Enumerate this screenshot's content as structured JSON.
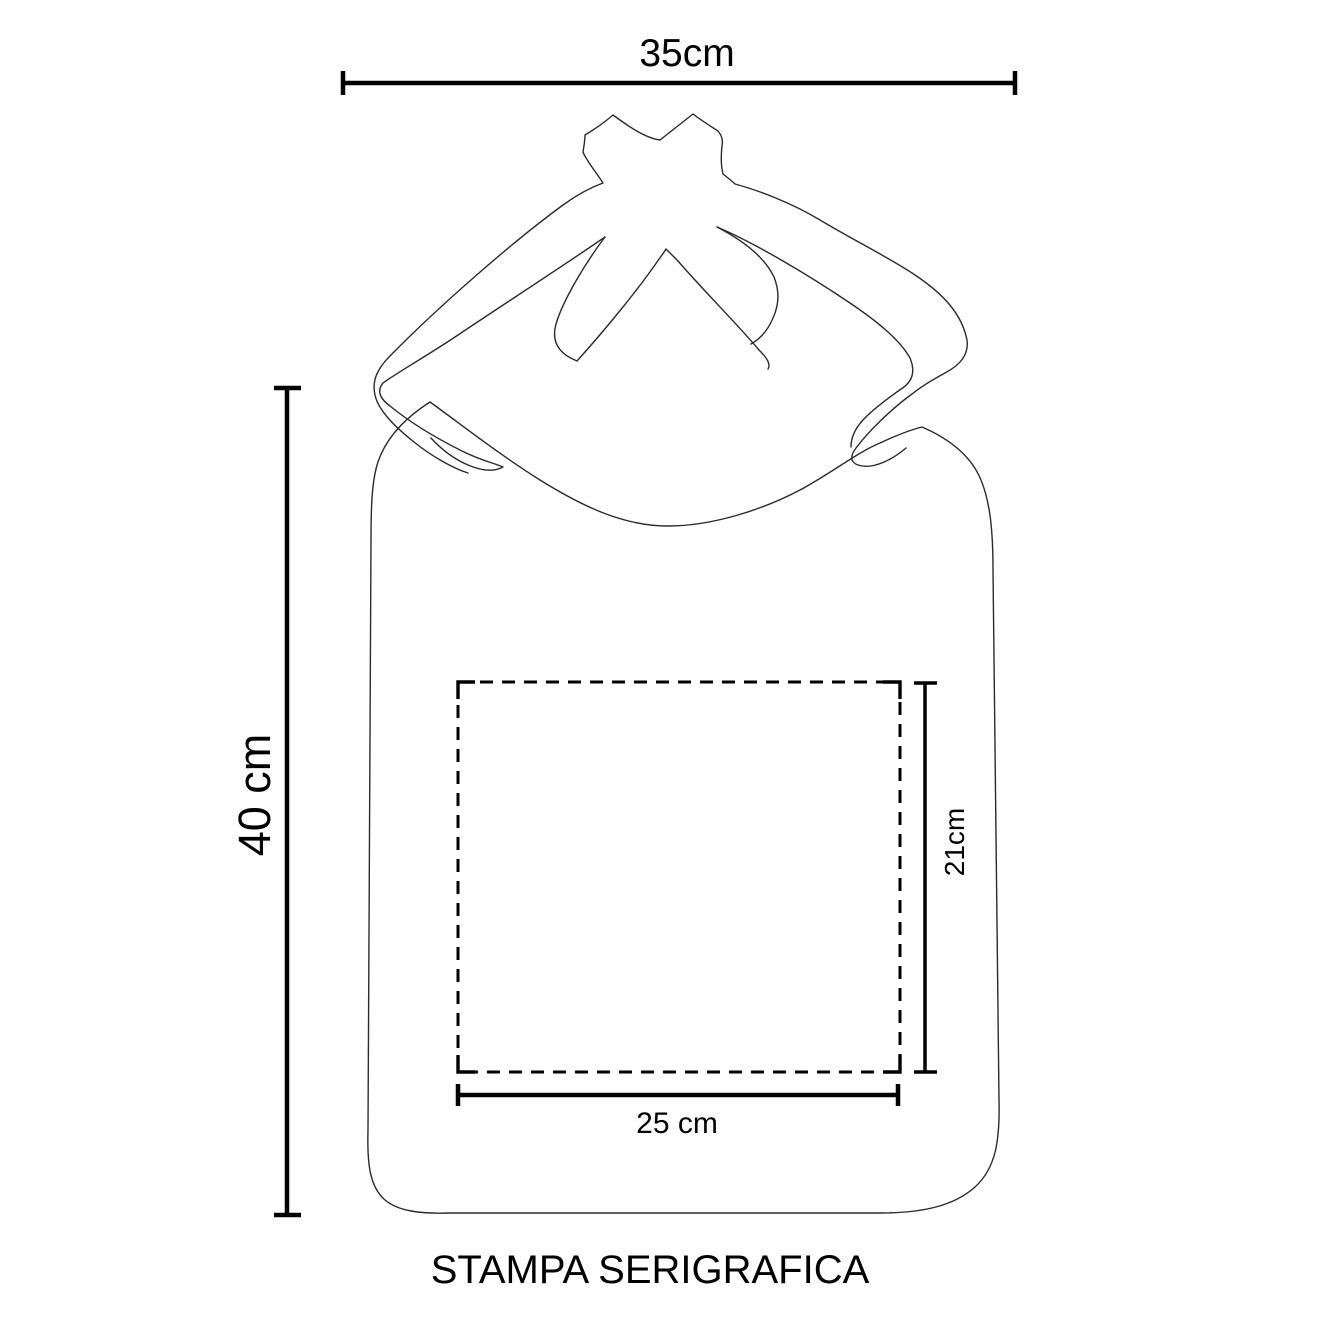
{
  "diagram": {
    "caption": "STAMPA SERIGRAFICA",
    "bag_width_label": "35cm",
    "bag_height_label": "40 cm",
    "print_area_width_label": "25 cm",
    "print_area_height_label": "21cm",
    "colors": {
      "background": "#ffffff",
      "dimension_lines": "#000000",
      "artwork_outline": "#2b2b2b"
    }
  }
}
